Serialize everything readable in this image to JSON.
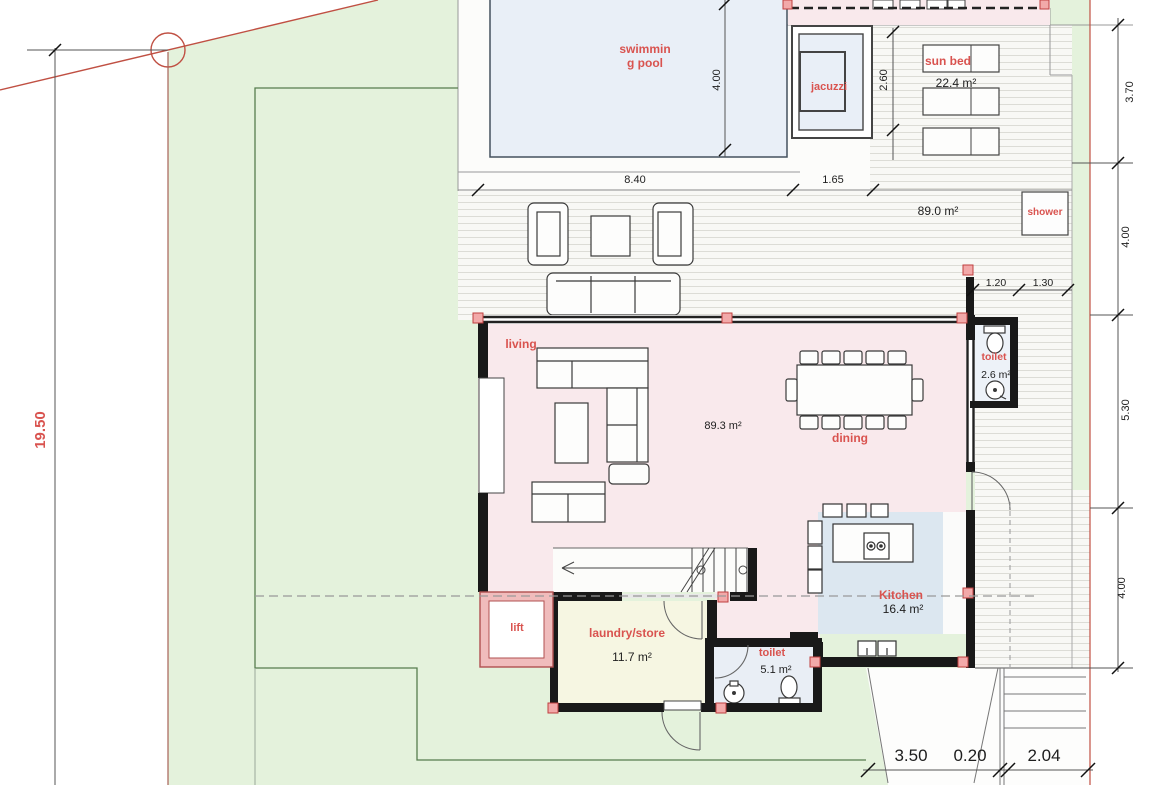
{
  "title": "villa-ground-floor-plan",
  "rooms": {
    "swimming_pool": {
      "name_line1": "swimmin",
      "name_line2": "g pool"
    },
    "jacuzzi": {
      "name": "jacuzzi"
    },
    "sun_bed": {
      "name": "sun bed",
      "area": "22.4 m²"
    },
    "terrace": {
      "area": "89.0 m²"
    },
    "shower": {
      "name": "shower"
    },
    "living": {
      "name": "living",
      "area": "89.3 m²"
    },
    "dining": {
      "name": "dining"
    },
    "toilet_upper": {
      "name": "toilet",
      "area": "2.6 m²"
    },
    "kitchen": {
      "name": "Kitchen",
      "area": "16.4 m²"
    },
    "laundry": {
      "name": "laundry/store",
      "area": "11.7 m²"
    },
    "toilet_lower": {
      "name": "toilet",
      "area": "5.1 m²"
    },
    "lift": {
      "name": "lift"
    }
  },
  "dimensions": {
    "site_left": "19.50",
    "pool_width": "8.40",
    "pool_to_jacuzzi": "1.65",
    "pool_height": "4.00",
    "jacuzzi_height": "2.60",
    "right_top": "3.70",
    "right_upper": "4.00",
    "right_middle": "5.30",
    "right_lower": "4.00",
    "toilet_width_a": "1.20",
    "toilet_width_b": "1.30",
    "bottom_a": "3.50",
    "bottom_b": "0.20",
    "bottom_c": "2.04"
  },
  "colors": {
    "lawn": "#e4f2dc",
    "deck_base": "#f8f8f5",
    "deck_stripe": "#dcdcd6",
    "pool_water": "#e9eff7",
    "house_fill": "#f9e9ec",
    "kitchen_fill": "#dce7f0",
    "laundry_fill": "#f6f6e2",
    "toilet_fill": "#e9eef5",
    "lift_wall": "#f0bcbc",
    "wall": "#191919",
    "post_fill": "#f2a9a9",
    "boundary_red": "#c05043",
    "boundary_green": "#567d4e",
    "label_red": "#d9534f"
  }
}
